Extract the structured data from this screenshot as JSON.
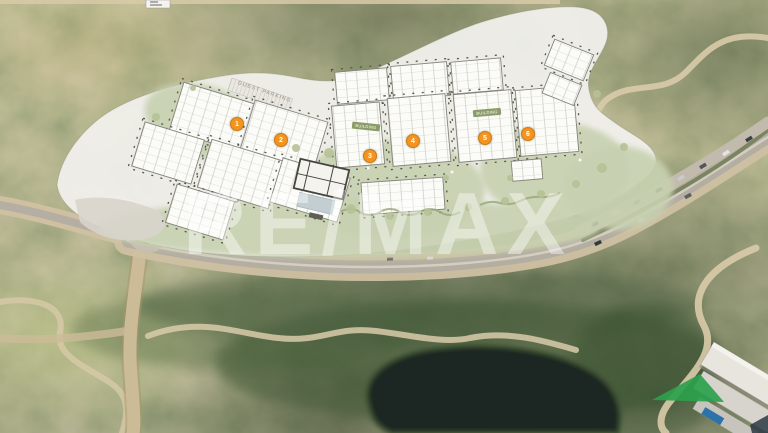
{
  "watermark": {
    "text": "RE/MAX"
  },
  "plan": {
    "guest_parking_label": "GUEST PARKING",
    "chips": [
      {
        "label": "BUILDING"
      },
      {
        "label": "BUILDING"
      }
    ],
    "markers": [
      {
        "label": "1"
      },
      {
        "label": "2"
      },
      {
        "label": "3"
      },
      {
        "label": "4"
      },
      {
        "label": "5"
      },
      {
        "label": "6"
      }
    ],
    "colors": {
      "marker": "#f2941f",
      "plan_paper": "#f0efeb",
      "apron_green": "#c7d0ae",
      "terrain_olive": "#77804f",
      "lake": "#1a2621",
      "asphalt": "#b4aea2",
      "sand_shoulder": "#cfc0a2",
      "bright_lawn": "#2ba14c"
    }
  }
}
